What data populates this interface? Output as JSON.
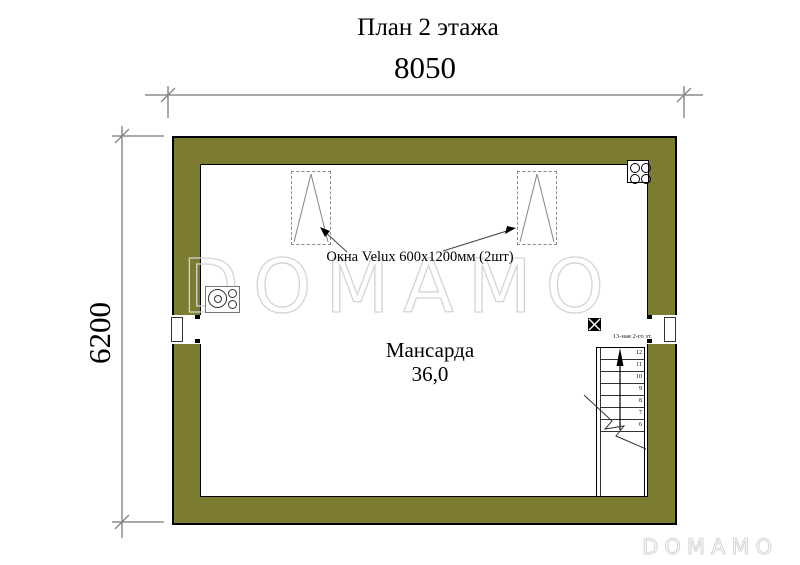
{
  "title": "План 2 этажа",
  "dimensions": {
    "width_label": "8050",
    "height_label": "6200"
  },
  "room": {
    "name": "Мансарда",
    "area": "36,0"
  },
  "windows": {
    "label": "Окна Velux 600х1200мм (2шт)",
    "count": 2
  },
  "stairs": {
    "note": "13-ная 2-го эт.",
    "steps": [
      "12",
      "11",
      "10",
      "9",
      "8",
      "7",
      "6"
    ]
  },
  "watermark": {
    "center": "DOMAMO",
    "corner": "DOMAMO"
  },
  "icons": {
    "vent": "chimney-flue-block",
    "stove": "boiler-stove-top-view",
    "shaft": "crossed-square-marker"
  },
  "colors": {
    "wall": "#7b7b31",
    "wm": "#d4d4d4",
    "ink": "#000000"
  }
}
